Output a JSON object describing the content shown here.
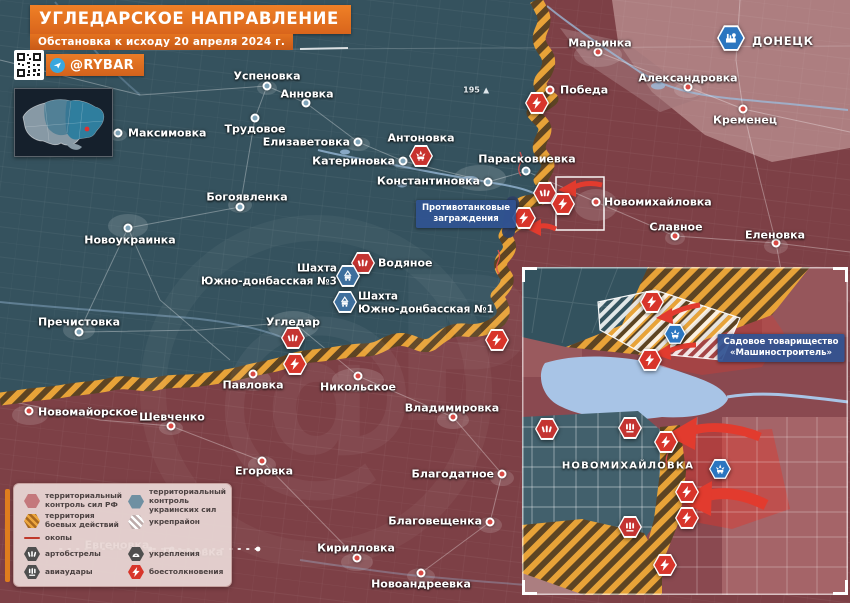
{
  "header": {
    "title": "УГЛЕДАРСКОЕ НАПРАВЛЕНИЕ",
    "subtitle": "Обстановка к исходу 20 апреля 2024 г.",
    "handle": "@RYBAR"
  },
  "colors": {
    "zone_ru": "#7d4046",
    "zone_ua": "#35525e",
    "front_hatch": "#e8a338",
    "water": "#9dbede",
    "arrow": "#e23b2e",
    "marker": {
      "clash": "#d8352b",
      "artillery": "#c43431",
      "airstrike": "#c43431",
      "strike": "#c8322e",
      "strike_blue": "#2b76c0",
      "mine": "#3e6f9d",
      "city": "#2b76c0"
    }
  },
  "map": {
    "height_mark": {
      "text": "195",
      "x": 476,
      "y": 90
    },
    "towns": [
      {
        "n": "Максимовка",
        "dot": [
          118,
          133
        ],
        "z": "ua",
        "label": [
          128,
          133
        ],
        "a": "l"
      },
      {
        "n": "Успеновка",
        "dot": [
          267,
          86
        ],
        "z": "ua",
        "label": [
          267,
          76
        ],
        "a": "c"
      },
      {
        "n": "Анновка",
        "dot": [
          306,
          103
        ],
        "z": "ua",
        "label": [
          307,
          94
        ],
        "a": "c"
      },
      {
        "n": "Трудовое",
        "dot": [
          255,
          118
        ],
        "z": "ua",
        "label": [
          255,
          129
        ],
        "a": "c"
      },
      {
        "n": "Елизаветовка",
        "dot": [
          358,
          142
        ],
        "z": "ua",
        "label": [
          350,
          142
        ],
        "a": "r"
      },
      {
        "n": "Катериновка",
        "dot": [
          403,
          161
        ],
        "z": "ua",
        "label": [
          395,
          161
        ],
        "a": "r"
      },
      {
        "n": "Константиновка",
        "dot": [
          488,
          182
        ],
        "z": "ua",
        "label": [
          480,
          181
        ],
        "a": "r"
      },
      {
        "n": "Парасковиевка",
        "dot": [
          526,
          171
        ],
        "z": "ua",
        "label": [
          527,
          159
        ],
        "a": "c"
      },
      {
        "n": "Антоновка",
        "dot": null,
        "z": "ua",
        "label": [
          421,
          138
        ],
        "a": "c"
      },
      {
        "n": "Богоявленка",
        "dot": [
          240,
          207
        ],
        "z": "ua",
        "label": [
          247,
          197
        ],
        "a": "c"
      },
      {
        "n": "Новоукраинка",
        "dot": [
          128,
          228
        ],
        "z": "ua",
        "label": [
          130,
          240
        ],
        "a": "c"
      },
      {
        "n": "Пречистовка",
        "dot": [
          79,
          332
        ],
        "z": "ua",
        "label": [
          79,
          322
        ],
        "a": "c"
      },
      {
        "n": "Водяное",
        "dot": null,
        "z": "ua",
        "label": [
          378,
          263
        ],
        "a": "l"
      },
      {
        "n": "Угледар",
        "dot": null,
        "z": "ua",
        "label": [
          293,
          322
        ],
        "a": "c"
      },
      {
        "n": "Марьинка",
        "dot": [
          598,
          52
        ],
        "z": "ru",
        "label": [
          600,
          43
        ],
        "a": "c"
      },
      {
        "n": "Победа",
        "dot": [
          550,
          90
        ],
        "z": "ru",
        "label": [
          560,
          90
        ],
        "a": "l"
      },
      {
        "n": "Александровка",
        "dot": [
          688,
          87
        ],
        "z": "ru",
        "label": [
          688,
          78
        ],
        "a": "c"
      },
      {
        "n": "Кременец",
        "dot": [
          743,
          109
        ],
        "z": "ru",
        "label": [
          745,
          120
        ],
        "a": "c"
      },
      {
        "n": "ДОНЕЦК",
        "dot": null,
        "z": "ru",
        "label": [
          752,
          41
        ],
        "a": "l",
        "caps": true
      },
      {
        "n": "Новомихайловка",
        "dot": [
          596,
          202
        ],
        "z": "ru",
        "label": [
          604,
          202
        ],
        "a": "l"
      },
      {
        "n": "Славное",
        "dot": [
          675,
          236
        ],
        "z": "ru",
        "label": [
          676,
          227
        ],
        "a": "c"
      },
      {
        "n": "Еленовка",
        "dot": [
          776,
          243
        ],
        "z": "ru",
        "label": [
          775,
          235
        ],
        "a": "c"
      },
      {
        "n": "Павловка",
        "dot": [
          253,
          374
        ],
        "z": "ru",
        "label": [
          253,
          385
        ],
        "a": "c"
      },
      {
        "n": "Никольское",
        "dot": [
          358,
          376
        ],
        "z": "ru",
        "label": [
          358,
          387
        ],
        "a": "c"
      },
      {
        "n": "Новомайорское",
        "dot": [
          29,
          411
        ],
        "z": "ru",
        "label": [
          38,
          412
        ],
        "a": "l"
      },
      {
        "n": "Шевченко",
        "dot": [
          171,
          426
        ],
        "z": "ru",
        "label": [
          172,
          417
        ],
        "a": "c"
      },
      {
        "n": "Егоровка",
        "dot": [
          262,
          461
        ],
        "z": "ru",
        "label": [
          264,
          471
        ],
        "a": "c"
      },
      {
        "n": "Владимировка",
        "dot": [
          453,
          417
        ],
        "z": "ru",
        "label": [
          452,
          408
        ],
        "a": "c"
      },
      {
        "n": "Благодатное",
        "dot": [
          502,
          474
        ],
        "z": "ru",
        "label": [
          494,
          474
        ],
        "a": "r"
      },
      {
        "n": "Благовещенка",
        "dot": [
          490,
          522
        ],
        "z": "ru",
        "label": [
          482,
          521
        ],
        "a": "r"
      },
      {
        "n": "Кирилловка",
        "dot": [
          357,
          558
        ],
        "z": "ru",
        "label": [
          356,
          548
        ],
        "a": "c"
      },
      {
        "n": "Новоандреевка",
        "dot": [
          421,
          573
        ],
        "z": "ru",
        "label": [
          421,
          584
        ],
        "a": "c"
      },
      {
        "n": "Евгеновка",
        "dot": null,
        "z": "ru",
        "label": [
          117,
          545
        ],
        "a": "c",
        "dim": true
      },
      {
        "n": "Петровка",
        "dot": null,
        "z": "ru",
        "label": [
          193,
          552
        ],
        "a": "c",
        "dim": true
      },
      {
        "n": "НОВОМИХАЙЛОВКА",
        "dot": null,
        "z": "ua",
        "label": [
          628,
          466
        ],
        "a": "c",
        "caps": true,
        "sm": true
      }
    ],
    "area_labels": [
      {
        "lines": [
          "Шахта",
          "Южно-донбасская №3"
        ],
        "x": 337,
        "y": 275,
        "a": "r"
      },
      {
        "lines": [
          "Шахта",
          "Южно-донбасская №1"
        ],
        "x": 358,
        "y": 303,
        "a": "l"
      }
    ],
    "markers": [
      {
        "t": "clash",
        "x": 537,
        "y": 103
      },
      {
        "t": "strike",
        "x": 421,
        "y": 156
      },
      {
        "t": "artillery",
        "x": 545,
        "y": 193
      },
      {
        "t": "clash",
        "x": 563,
        "y": 204
      },
      {
        "t": "clash",
        "x": 524,
        "y": 218
      },
      {
        "t": "artillery",
        "x": 363,
        "y": 263
      },
      {
        "t": "mine",
        "x": 348,
        "y": 276
      },
      {
        "t": "mine",
        "x": 345,
        "y": 302
      },
      {
        "t": "artillery",
        "x": 293,
        "y": 338
      },
      {
        "t": "clash",
        "x": 295,
        "y": 364
      },
      {
        "t": "clash",
        "x": 497,
        "y": 340
      },
      {
        "t": "city",
        "x": 731,
        "y": 38,
        "s": 28
      },
      {
        "t": "clash",
        "x": 652,
        "y": 302
      },
      {
        "t": "clash",
        "x": 650,
        "y": 360
      },
      {
        "t": "strike_blue",
        "x": 675,
        "y": 334,
        "s": 22
      },
      {
        "t": "artillery",
        "x": 547,
        "y": 429
      },
      {
        "t": "airstrike",
        "x": 630,
        "y": 428
      },
      {
        "t": "clash",
        "x": 666,
        "y": 442
      },
      {
        "t": "strike_blue",
        "x": 720,
        "y": 469,
        "s": 22
      },
      {
        "t": "clash",
        "x": 687,
        "y": 492
      },
      {
        "t": "clash",
        "x": 687,
        "y": 518
      },
      {
        "t": "airstrike",
        "x": 630,
        "y": 527
      },
      {
        "t": "clash",
        "x": 665,
        "y": 565
      }
    ],
    "callouts": [
      {
        "lines": [
          "Противотанковые",
          "заграждения"
        ],
        "x": 466,
        "y": 214
      },
      {
        "lines": [
          "Садовое товарищество",
          "«Машиностроитель»"
        ],
        "x": 781,
        "y": 348
      }
    ]
  },
  "legend": {
    "columns": [
      [
        {
          "icon": "zone-ru",
          "label": "территориальный контроль сил РФ",
          "h": "rh20"
        },
        {
          "icon": "combat-zone",
          "label": "территория боевых действий",
          "h": "rh20"
        },
        {
          "icon": "trench-line",
          "label": "окопы",
          "h": "rh13"
        },
        {
          "icon": "artillery",
          "label": "артобстрелы",
          "h": "rh18"
        },
        {
          "icon": "airstrike",
          "label": "авиаудары",
          "h": "rh18"
        }
      ],
      [
        {
          "icon": "zone-ua",
          "label": "территориальный контроль украинских сил",
          "h": "rh20"
        },
        {
          "icon": "fort-area",
          "label": "укрепрайон",
          "h": "rh20"
        },
        {
          "icon": "none",
          "label": "",
          "h": "rh13"
        },
        {
          "icon": "fortification",
          "label": "укрепления",
          "h": "rh18"
        },
        {
          "icon": "clash",
          "label": "боестолкновения",
          "h": "rh18"
        }
      ]
    ]
  }
}
